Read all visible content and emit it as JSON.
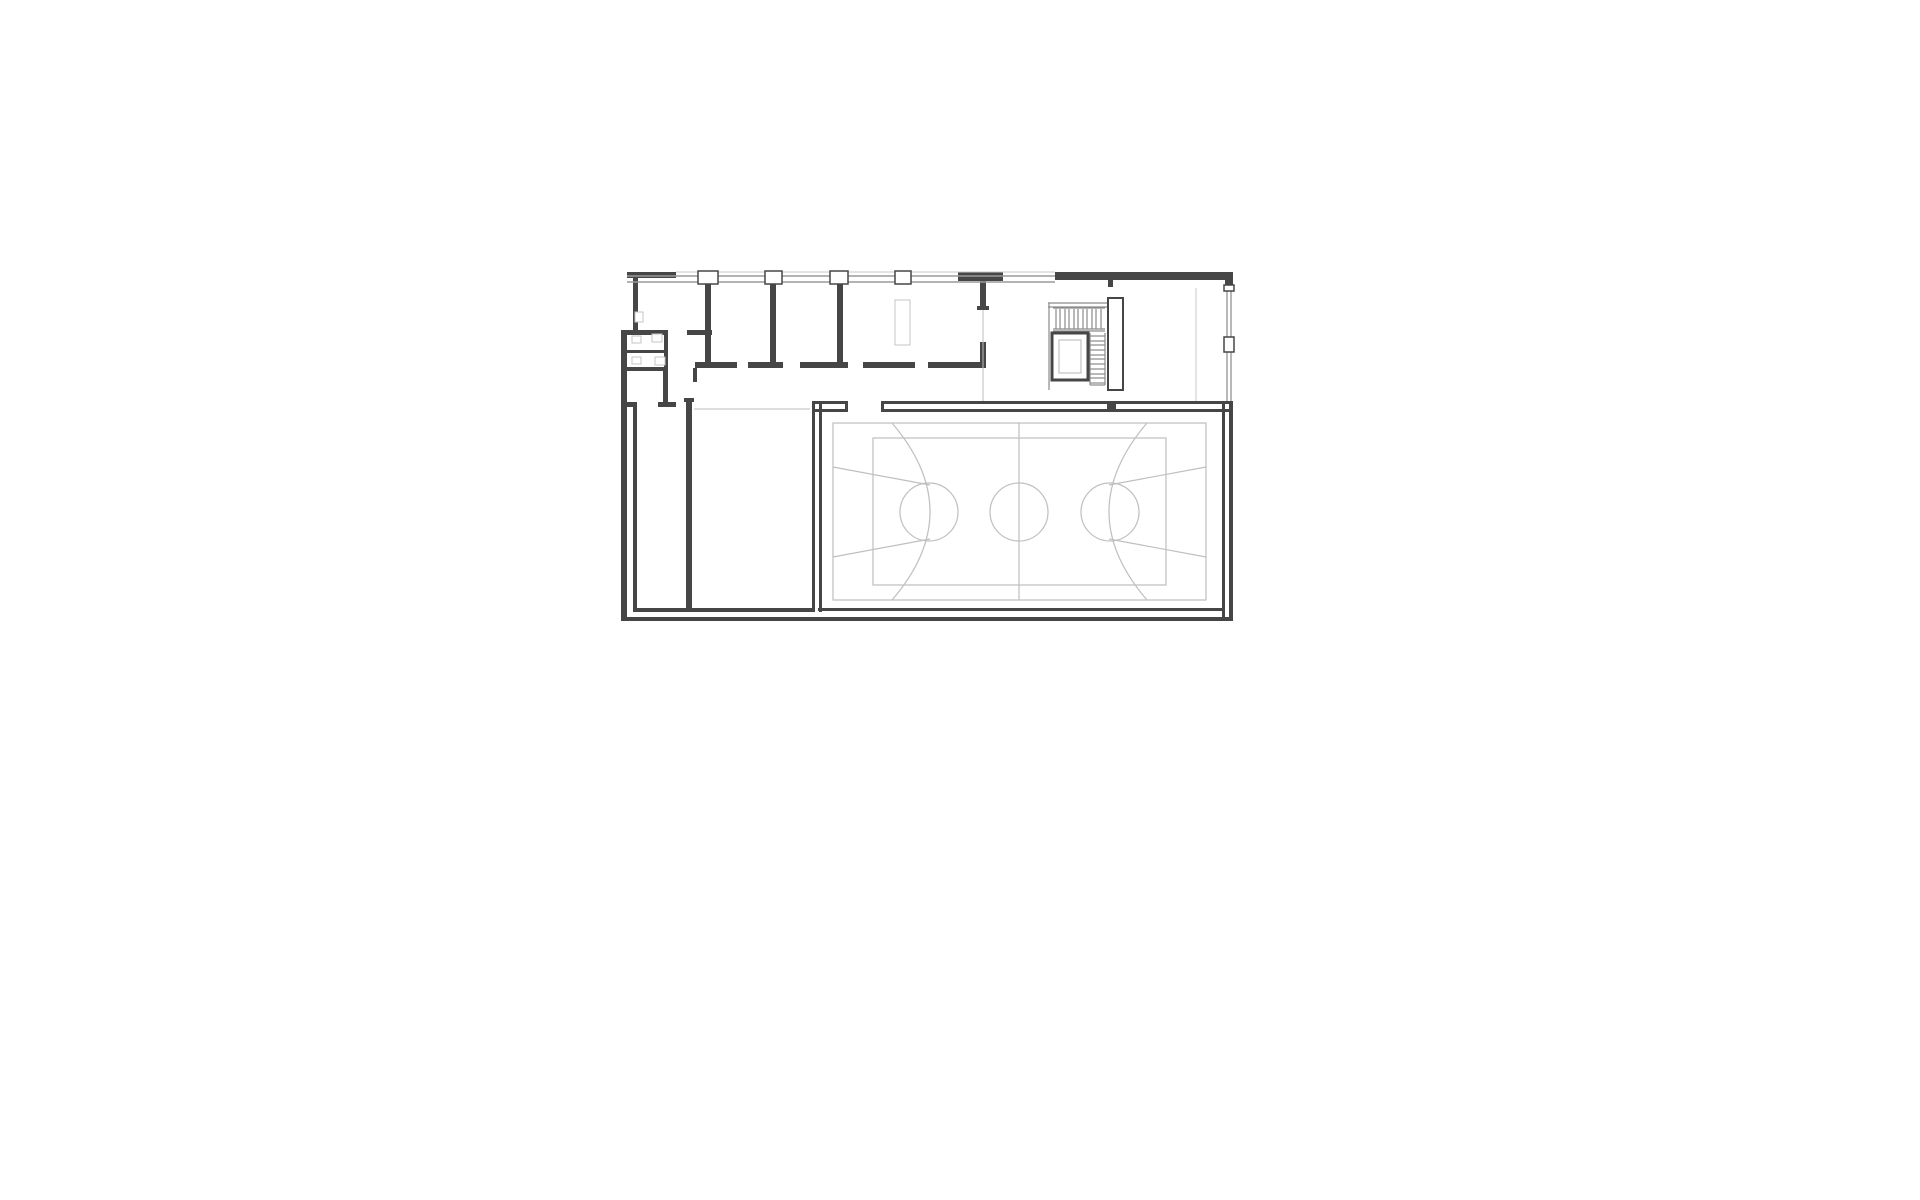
{
  "document": {
    "type": "architectural-floor-plan",
    "visible_text": ""
  },
  "plan": {
    "canvas": {
      "w": 1920,
      "h": 1200,
      "bg": "#ffffff"
    },
    "colors": {
      "wall": "#464646",
      "window_band": "#9a9a9a",
      "faint": "#c9c9c9",
      "stair": "#8a8a8a",
      "court": "#bfbfbf",
      "fixture": "#c6c6c6"
    },
    "groups": [
      {
        "name": "envelope-walls",
        "fill": "#464646",
        "rects": [
          [
            633,
            272,
            5,
            58
          ],
          [
            621,
            330,
            6,
            291
          ],
          [
            627,
            272,
            49,
            6
          ],
          [
            1055,
            272,
            178,
            8
          ],
          [
            1108,
            280,
            5,
            7
          ],
          [
            1225,
            279,
            8,
            11
          ],
          [
            958,
            272,
            45,
            9
          ],
          [
            622,
            617,
            611,
            4
          ],
          [
            812,
            401,
            36,
            3
          ],
          [
            884,
            401,
            349,
            3
          ],
          [
            812,
            409,
            36,
            3
          ],
          [
            884,
            409,
            349,
            3
          ],
          [
            845,
            401,
            3,
            11
          ],
          [
            881,
            401,
            3,
            11
          ],
          [
            812,
            404,
            3,
            208
          ],
          [
            819,
            404,
            3,
            208
          ],
          [
            818,
            608,
            407,
            3
          ],
          [
            1222,
            404,
            3,
            213
          ],
          [
            1229,
            401,
            4,
            220
          ],
          [
            1107,
            401,
            9,
            9
          ]
        ]
      },
      {
        "name": "interior-walls",
        "fill": "#464646",
        "rects": [
          [
            705,
            283,
            6,
            81
          ],
          [
            770,
            283,
            6,
            81
          ],
          [
            837,
            283,
            6,
            81
          ],
          [
            980,
            281,
            6,
            29
          ],
          [
            977,
            306,
            12,
            4
          ],
          [
            980,
            342,
            6,
            26
          ],
          [
            928,
            362,
            58,
            6
          ],
          [
            695,
            362,
            42,
            6
          ],
          [
            748,
            362,
            35,
            6
          ],
          [
            800,
            362,
            48,
            6
          ],
          [
            863,
            362,
            52,
            6
          ],
          [
            693,
            368,
            4,
            14
          ],
          [
            627,
            330,
            41,
            5
          ],
          [
            687,
            330,
            25,
            5
          ],
          [
            627,
            350,
            38,
            3
          ],
          [
            664,
            332,
            4,
            38
          ],
          [
            621,
            367,
            47,
            4
          ],
          [
            663,
            371,
            5,
            31
          ],
          [
            658,
            402,
            18,
            5
          ],
          [
            627,
            402,
            10,
            5
          ],
          [
            686,
            398,
            6,
            214
          ],
          [
            684,
            398,
            10,
            4
          ],
          [
            633,
            407,
            4,
            205
          ],
          [
            633,
            608,
            179,
            4
          ]
        ]
      },
      {
        "name": "window-bands",
        "stroke": "#9a9a9a",
        "sw": 1.4,
        "lines": [
          [
            627,
            276,
            1055,
            276
          ],
          [
            627,
            282,
            1055,
            282
          ],
          [
            1227,
            288,
            1227,
            401
          ],
          [
            1231,
            288,
            1231,
            401
          ]
        ]
      },
      {
        "name": "facade-faint-lines",
        "stroke": "#c9c9c9",
        "sw": 1,
        "lines": [
          [
            676,
            272,
            1055,
            272
          ],
          [
            1196,
            288,
            1196,
            401
          ]
        ]
      },
      {
        "name": "facade-columns",
        "stroke": "#464646",
        "sw": 1.5,
        "outlined": [
          [
            698,
            271,
            20,
            13
          ],
          [
            765,
            271,
            17,
            13
          ],
          [
            830,
            271,
            18,
            13
          ],
          [
            895,
            271,
            16,
            13
          ],
          [
            1224,
            285,
            10,
            6
          ],
          [
            1224,
            337,
            10,
            15
          ]
        ]
      },
      {
        "name": "stair-structure",
        "stroke": "#8a8a8a",
        "sw": 1.2,
        "lines": [
          [
            1048,
            303,
            1108,
            303
          ],
          [
            1048,
            307,
            1108,
            307
          ],
          [
            1049,
            303,
            1049,
            390
          ],
          [
            1053,
            308,
            1105,
            308
          ],
          [
            1053,
            329,
            1105,
            329
          ],
          [
            1053,
            331,
            1105,
            331
          ],
          [
            1090,
            333,
            1090,
            385
          ],
          [
            1105,
            333,
            1105,
            385
          ],
          [
            1090,
            385,
            1105,
            385
          ],
          [
            1056,
            309,
            1056,
            329
          ],
          [
            1060,
            309,
            1060,
            329
          ],
          [
            1065,
            309,
            1065,
            329
          ],
          [
            1069,
            309,
            1069,
            329
          ],
          [
            1074,
            309,
            1074,
            329
          ],
          [
            1078,
            309,
            1078,
            329
          ],
          [
            1083,
            309,
            1083,
            329
          ],
          [
            1087,
            309,
            1087,
            329
          ],
          [
            1092,
            309,
            1092,
            329
          ],
          [
            1096,
            309,
            1096,
            329
          ],
          [
            1101,
            309,
            1101,
            329
          ],
          [
            1090,
            336,
            1105,
            336
          ],
          [
            1090,
            341,
            1105,
            341
          ],
          [
            1090,
            345,
            1105,
            345
          ],
          [
            1090,
            350,
            1105,
            350
          ],
          [
            1090,
            355,
            1105,
            355
          ],
          [
            1090,
            359,
            1105,
            359
          ],
          [
            1090,
            364,
            1105,
            364
          ],
          [
            1090,
            369,
            1105,
            369
          ],
          [
            1090,
            374,
            1105,
            374
          ],
          [
            1090,
            378,
            1105,
            378
          ],
          [
            1090,
            383,
            1105,
            383
          ]
        ]
      },
      {
        "name": "stair-pier",
        "stroke": "#464646",
        "sw": 2,
        "outlined": [
          [
            1108,
            298,
            15,
            92
          ]
        ]
      },
      {
        "name": "elevator-shaft",
        "stroke": "#464646",
        "sw": 3,
        "outlined": [
          [
            1052,
            333,
            36,
            47
          ]
        ]
      },
      {
        "name": "elevator-car",
        "stroke": "#b5b5b5",
        "sw": 1,
        "outlined": [
          [
            1059,
            340,
            22,
            33
          ]
        ]
      },
      {
        "name": "basketball-court",
        "stroke": "#bfbfbf",
        "sw": 1.2,
        "rects_outline": [
          [
            833,
            423,
            373,
            177
          ],
          [
            873,
            438,
            293,
            147
          ]
        ],
        "lines": [
          [
            1019,
            423,
            1019,
            600
          ],
          [
            833,
            467,
            930,
            485
          ],
          [
            833,
            557,
            930,
            539
          ],
          [
            1206,
            467,
            1109,
            485
          ],
          [
            1206,
            557,
            1109,
            539
          ]
        ],
        "circles": [
          [
            929,
            512,
            29
          ],
          [
            1019,
            512,
            29
          ],
          [
            1110,
            512,
            29
          ]
        ],
        "paths": [
          "M892,423 Q968,512 892,600",
          "M1147,423 Q1071,512 1147,600"
        ]
      },
      {
        "name": "corridor-lines",
        "stroke": "#bdbdbd",
        "sw": 1,
        "lines": [
          [
            694,
            409,
            810,
            409
          ],
          [
            983,
            310,
            983,
            401
          ]
        ]
      },
      {
        "name": "fixtures",
        "stroke": "#c6c6c6",
        "sw": 1,
        "outlined": [
          [
            632,
            336,
            9,
            7
          ],
          [
            652,
            334,
            10,
            8
          ],
          [
            632,
            357,
            9,
            7
          ],
          [
            655,
            357,
            10,
            8
          ],
          [
            635,
            312,
            8,
            10
          ],
          [
            895,
            300,
            15,
            45
          ]
        ]
      }
    ]
  }
}
